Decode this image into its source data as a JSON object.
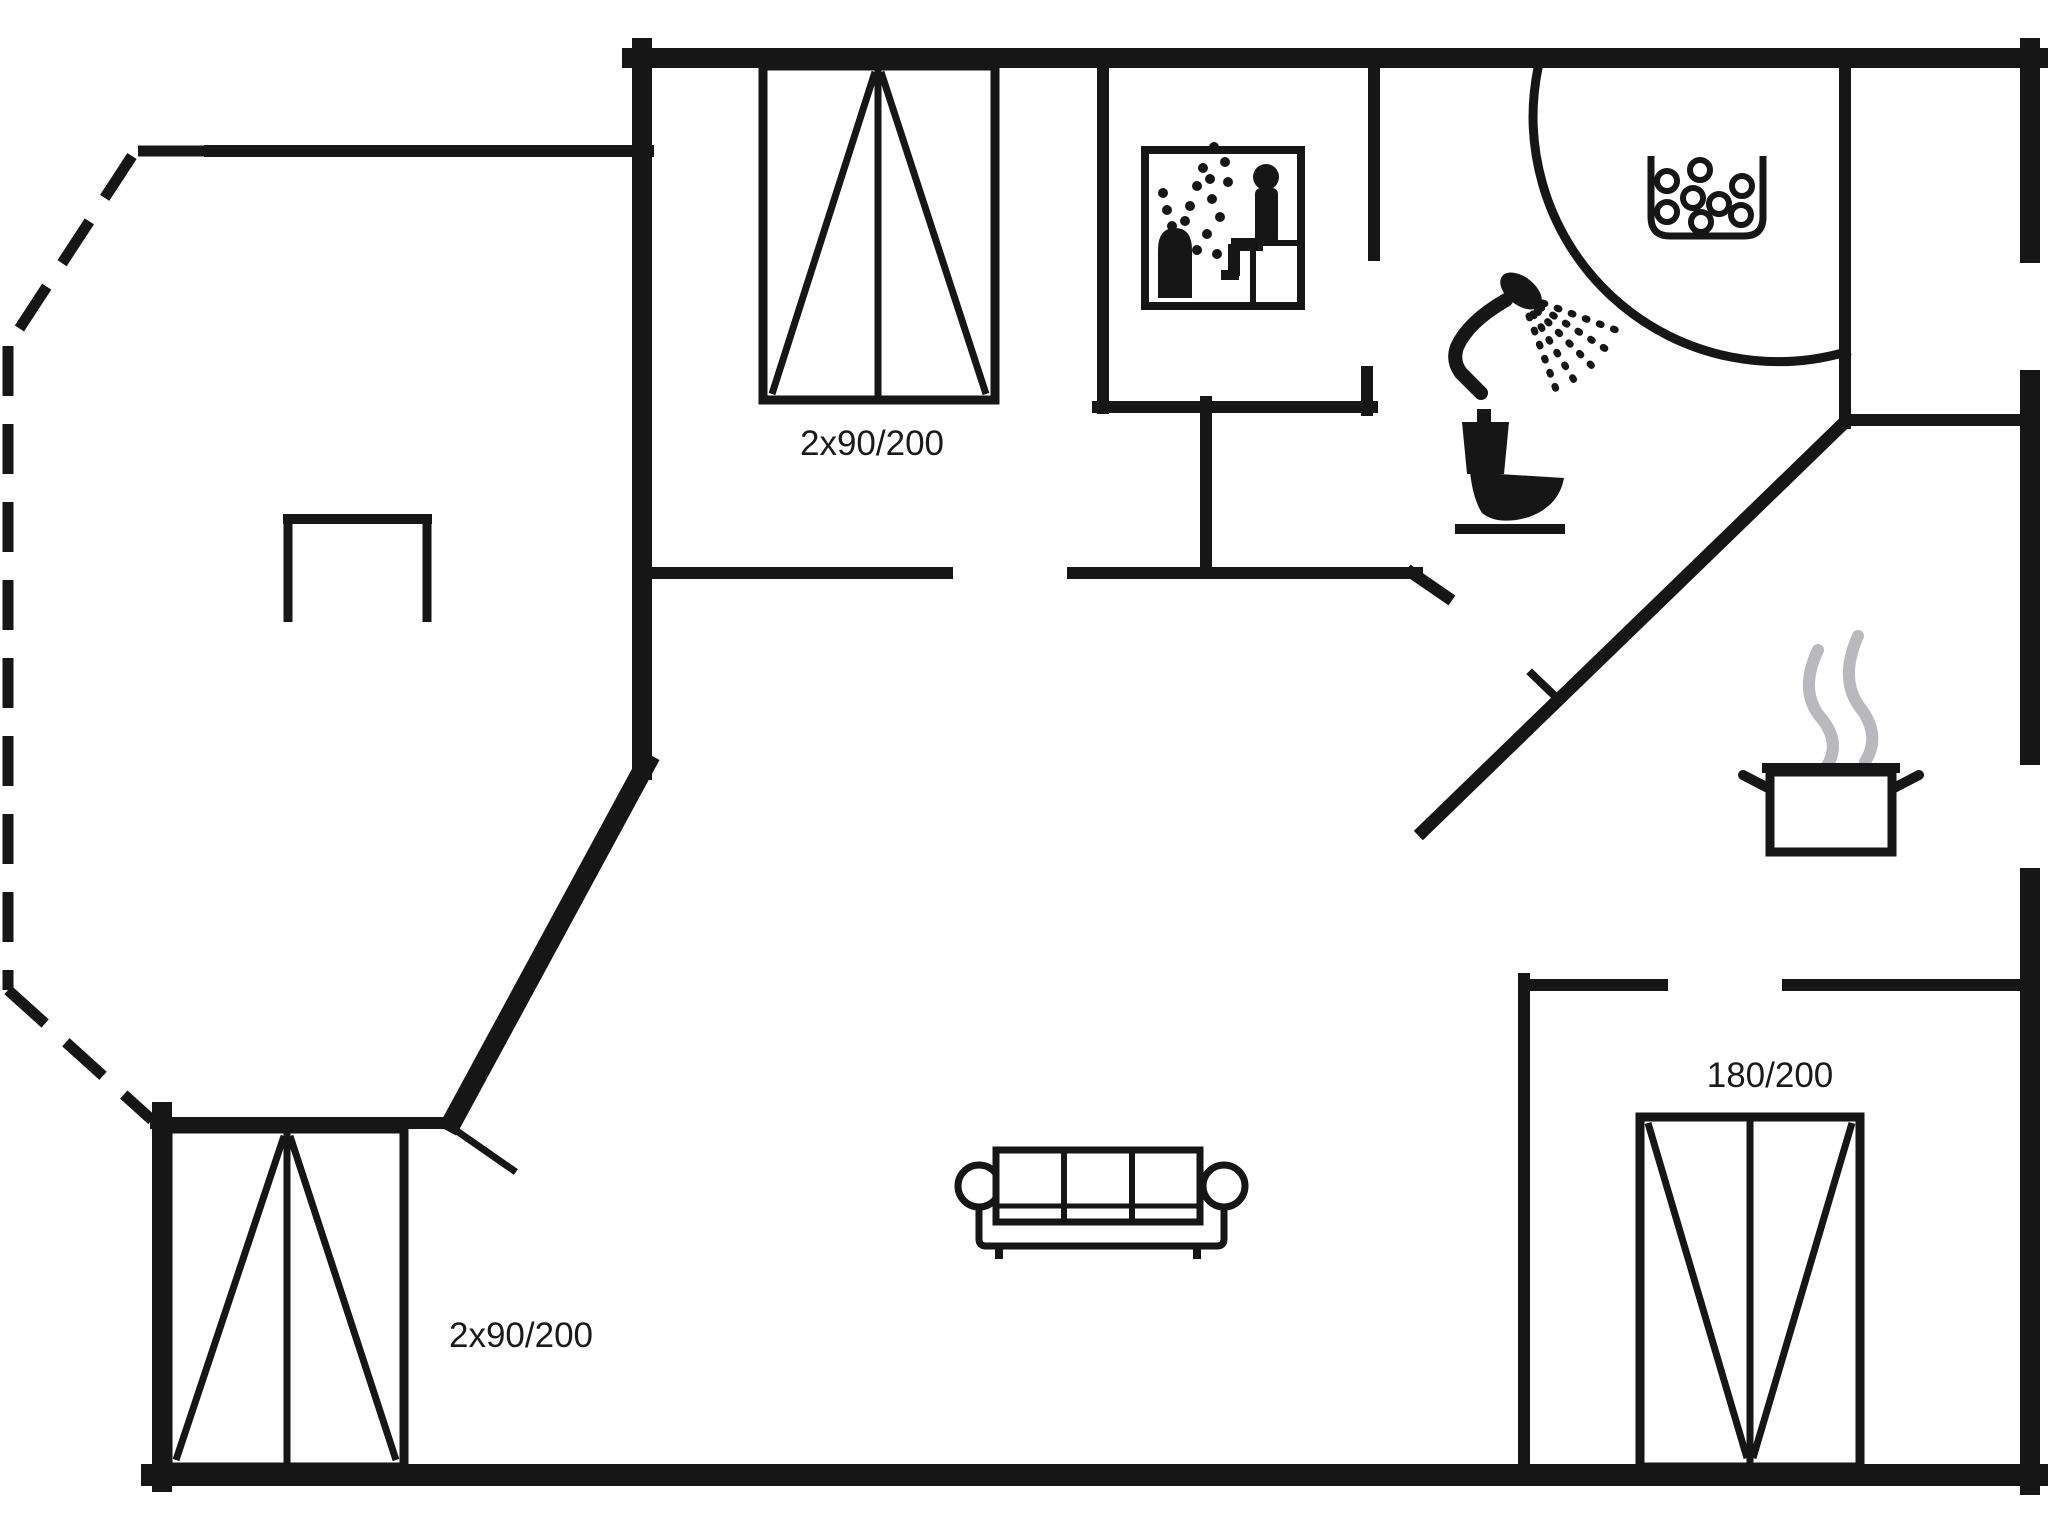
{
  "plan": {
    "type": "holiday-home floor plan",
    "colors": {
      "background": "#ffffff",
      "line": "#161616",
      "text": "#1a1a1a",
      "steam": "#b9b9bd"
    },
    "labels": {
      "bed_top": "2x90/200",
      "bed_bottom_left": "2x90/200",
      "bed_bottom_right": "180/200"
    },
    "icons": {
      "sauna": "sauna-pictogram",
      "shower": "handheld-shower-icon",
      "toilet": "toilet-icon",
      "washbasin": "washbasin-bubbles-icon",
      "stove": "steaming-pot-icon",
      "sofa": "three-seat-sofa-icon",
      "beds": "double-bed-symbol",
      "terrace": "dashed-terrace-outline",
      "door": "door-swing-line"
    }
  }
}
